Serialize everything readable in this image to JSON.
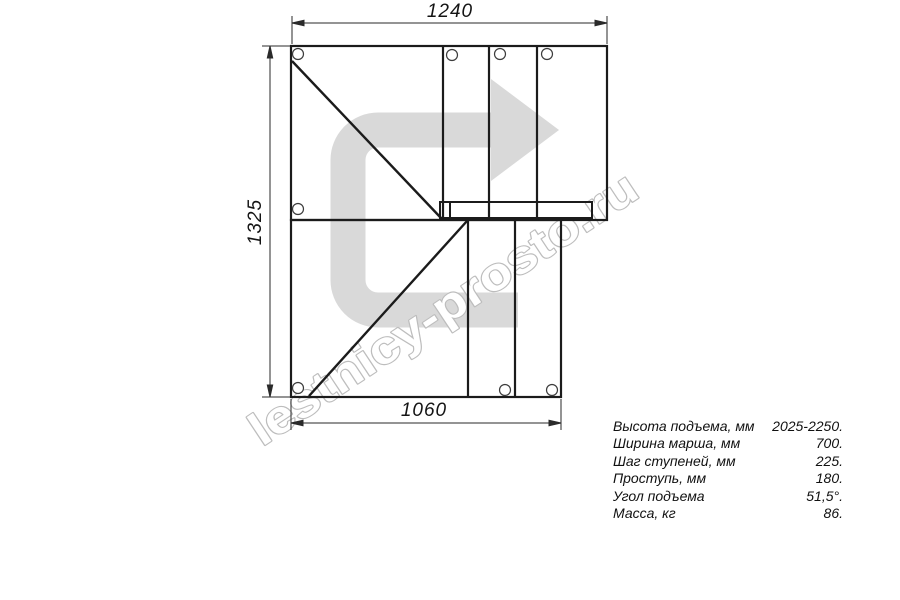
{
  "drawing": {
    "dim_top": "1240",
    "dim_left": "1325",
    "dim_bottom": "1060"
  },
  "watermark": {
    "text": "lestnicy-prosto.ru",
    "arrow_color": "#d9d9d9",
    "outline_color": "#bdbdbd"
  },
  "specs": {
    "rows": [
      {
        "label": "Высота подъема, мм",
        "value": "2025-2250."
      },
      {
        "label": "Ширина марша, мм",
        "value": "700."
      },
      {
        "label": "Шаг ступеней, мм",
        "value": "225."
      },
      {
        "label": "Проступь, мм",
        "value": "180."
      },
      {
        "label": "Угол подъема",
        "value": "51,5°."
      },
      {
        "label": "Масса, кг",
        "value": "86."
      }
    ]
  }
}
